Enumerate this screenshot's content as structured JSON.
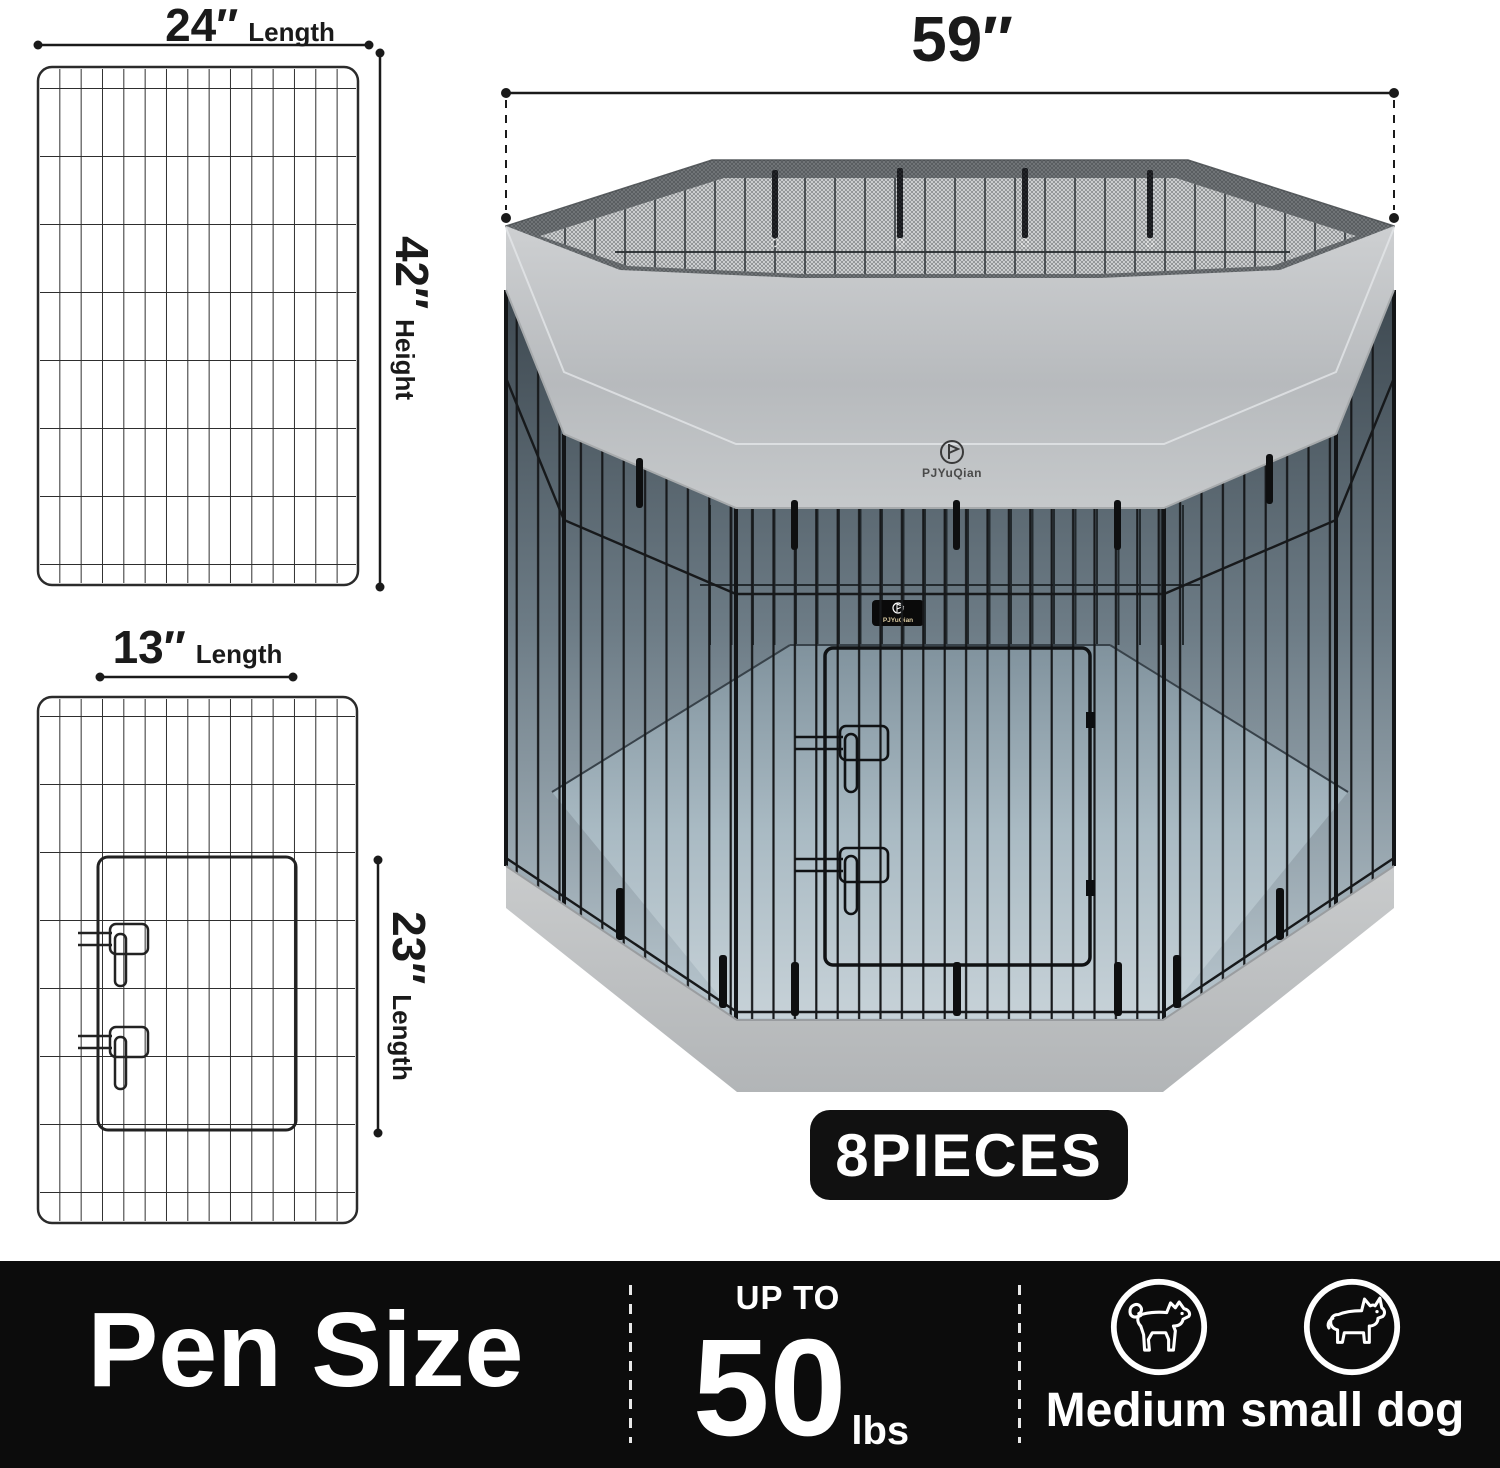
{
  "product": {
    "brand": "PJYuQian"
  },
  "diagrams": {
    "large_panel": {
      "length": "24″",
      "length_label": "Length",
      "height": "42″",
      "height_label": "Height"
    },
    "door_panel": {
      "length": "13″",
      "length_label": "Length",
      "height": "23″",
      "height_label": "Length"
    },
    "pen_width": "59″",
    "pieces_badge": "8PIECES"
  },
  "footer": {
    "title": "Pen Size",
    "weight": {
      "prefix": "UP TO",
      "value": "50",
      "unit": "lbs"
    },
    "dog_size_label": "Medium small dog",
    "icons": [
      "medium-dog-icon",
      "small-dog-icon"
    ]
  },
  "colors": {
    "footer_bg": "#0c0c0c",
    "badge_bg": "#111111",
    "cover_gray": "#c3c6c9",
    "floor_blue_gray": "#b6c4cc",
    "mesh_gray": "#6f7376",
    "wire_black": "#1a1a1a"
  }
}
